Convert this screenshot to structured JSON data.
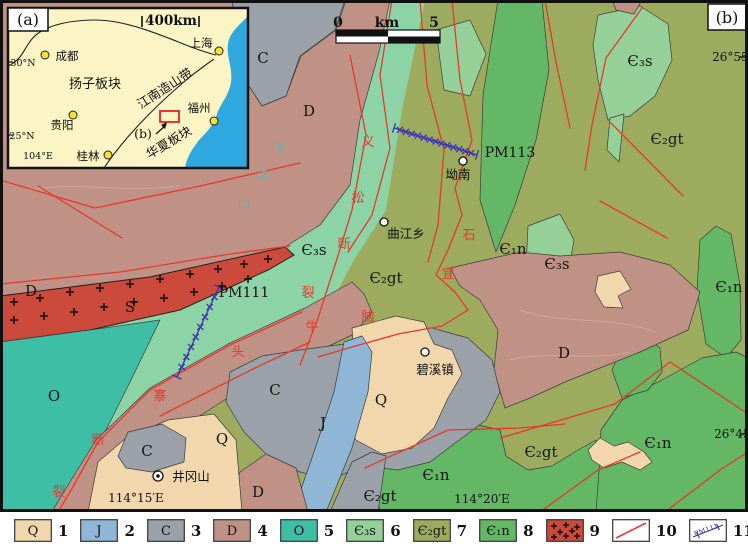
{
  "colors": {
    "units": {
      "Q": "#F2D7AD",
      "J": "#90B6D5",
      "C": "#9BA1A8",
      "D": "#BF9285",
      "O": "#3FBEA6",
      "E3s": "#95D099",
      "E3sB": "#8CD3A6",
      "E2gt": "#9CAB5E",
      "E1n": "#63B765",
      "granite": "#CB4A3B"
    },
    "fault_line": "#E8382C",
    "traverse_line": "#3D36A6",
    "sea": "#2FA8DF",
    "inset_land": "#FBF5C6",
    "city_dot": "#F7E03C",
    "study_area_box": "#EE1C25"
  },
  "map": {
    "panel_label": "(b)",
    "scale_bar": {
      "left": "0",
      "mid": "km",
      "right": "5"
    },
    "labels": [
      {
        "t": "C",
        "x": 263,
        "y": 63,
        "k": "unit",
        "s": 17
      },
      {
        "t": "D",
        "x": 309,
        "y": 116,
        "k": "unit",
        "s": 17
      },
      {
        "t": "D",
        "x": 31,
        "y": 296,
        "k": "unit",
        "s": 17
      },
      {
        "t": "S",
        "x": 130,
        "y": 312,
        "k": "unit",
        "s": 15
      },
      {
        "t": "O",
        "x": 54,
        "y": 401,
        "k": "unit",
        "s": 17
      },
      {
        "t": "C",
        "x": 147,
        "y": 456,
        "k": "unit",
        "s": 15
      },
      {
        "t": "Q",
        "x": 222,
        "y": 444,
        "k": "unit",
        "s": 17
      },
      {
        "t": "C",
        "x": 275,
        "y": 395,
        "k": "unit",
        "s": 15
      },
      {
        "t": "J",
        "x": 323,
        "y": 428,
        "k": "unit",
        "s": 15
      },
      {
        "t": "D",
        "x": 258,
        "y": 497,
        "k": "unit",
        "s": 15
      },
      {
        "t": "Q",
        "x": 381,
        "y": 405,
        "k": "unit",
        "s": 14
      },
      {
        "t": "D",
        "x": 564,
        "y": 358,
        "k": "unit",
        "s": 17
      },
      {
        "t": "Є₃s",
        "x": 314,
        "y": 255,
        "k": "unit"
      },
      {
        "t": "Є₂gt",
        "x": 386,
        "y": 283,
        "k": "unit"
      },
      {
        "t": "Є₃s",
        "x": 640,
        "y": 66,
        "k": "unit"
      },
      {
        "t": "Є₂gt",
        "x": 667,
        "y": 144,
        "k": "unit"
      },
      {
        "t": "Є₁n",
        "x": 513,
        "y": 254,
        "k": "unit"
      },
      {
        "t": "Є₃s",
        "x": 557,
        "y": 269,
        "k": "unit"
      },
      {
        "t": "Є₁n",
        "x": 729,
        "y": 292,
        "k": "unit"
      },
      {
        "t": "Є₂gt",
        "x": 541,
        "y": 457,
        "k": "unit"
      },
      {
        "t": "Є₁n",
        "x": 658,
        "y": 448,
        "k": "unit"
      },
      {
        "t": "Є₁n",
        "x": 436,
        "y": 480,
        "k": "unit"
      },
      {
        "t": "Є₂gt",
        "x": 380,
        "y": 501,
        "k": "unit"
      },
      {
        "t": "坳南",
        "x": 458,
        "y": 179,
        "k": "town"
      },
      {
        "t": "曲江乡",
        "x": 406,
        "y": 238,
        "k": "town"
      },
      {
        "t": "碧溪镇",
        "x": 435,
        "y": 374,
        "k": "town"
      },
      {
        "t": "井冈山",
        "x": 191,
        "y": 481,
        "k": "town"
      },
      {
        "t": "PM113",
        "x": 510,
        "y": 157,
        "k": "trav"
      },
      {
        "t": "PM111",
        "x": 244,
        "y": 297,
        "k": "trav"
      },
      {
        "t": "义",
        "x": 368,
        "y": 146,
        "k": "fault"
      },
      {
        "t": "松",
        "x": 358,
        "y": 202,
        "k": "fault"
      },
      {
        "t": "断",
        "x": 344,
        "y": 248,
        "k": "fault"
      },
      {
        "t": "裂",
        "x": 308,
        "y": 297,
        "k": "fault"
      },
      {
        "t": "牛",
        "x": 312,
        "y": 331,
        "k": "fault"
      },
      {
        "t": "头",
        "x": 238,
        "y": 356,
        "k": "fault"
      },
      {
        "t": "寨",
        "x": 160,
        "y": 400,
        "k": "fault"
      },
      {
        "t": "断",
        "x": 98,
        "y": 444,
        "k": "fault"
      },
      {
        "t": "裂",
        "x": 59,
        "y": 496,
        "k": "fault"
      },
      {
        "t": "石",
        "x": 469,
        "y": 239,
        "k": "fault"
      },
      {
        "t": "宜",
        "x": 448,
        "y": 278,
        "k": "fault"
      },
      {
        "t": "脑",
        "x": 368,
        "y": 321,
        "k": "fault"
      },
      {
        "t": "南",
        "x": 278,
        "y": 151,
        "k": "mtn"
      },
      {
        "t": "华",
        "x": 263,
        "y": 179,
        "k": "mtn"
      },
      {
        "t": "山",
        "x": 244,
        "y": 208,
        "k": "mtn"
      },
      {
        "t": "26°55′N",
        "x": 737,
        "y": 61,
        "k": "coord",
        "a": "end"
      },
      {
        "t": "26°45′N",
        "x": 739,
        "y": 438,
        "k": "coord",
        "a": "end"
      },
      {
        "t": "114°15′E",
        "x": 136,
        "y": 502,
        "k": "coord"
      },
      {
        "t": "114°20′E",
        "x": 482,
        "y": 503,
        "k": "coord"
      },
      {
        "t": "0",
        "x": 338,
        "y": 27,
        "k": "scale"
      },
      {
        "t": "km",
        "x": 387,
        "y": 27,
        "k": "scale"
      },
      {
        "t": "5",
        "x": 434,
        "y": 27,
        "k": "scale"
      }
    ],
    "towns": [
      {
        "name": "坳南",
        "x": 463,
        "y": 161,
        "double": false
      },
      {
        "name": "曲江乡",
        "x": 384,
        "y": 222,
        "double": false
      },
      {
        "name": "碧溪镇",
        "x": 425,
        "y": 352,
        "double": false
      },
      {
        "name": "井冈山",
        "x": 158,
        "y": 476,
        "double": true
      }
    ],
    "traverses": [
      {
        "name": "PM113",
        "x1": 394,
        "y1": 128,
        "x2": 477,
        "y2": 155,
        "n": 13
      },
      {
        "name": "PM111",
        "x1": 219,
        "y1": 287,
        "x2": 177,
        "y2": 377,
        "n": 8
      }
    ]
  },
  "inset": {
    "panel_label": "(a)",
    "labels": [
      {
        "t": "400km",
        "x": 163,
        "y": 17,
        "s": 13.5,
        "w": 700
      },
      {
        "t": "扬子板块",
        "x": 87,
        "y": 80,
        "s": 13
      },
      {
        "t": "江南造山带",
        "x": 159,
        "y": 84,
        "s": 12.5,
        "rot": -33
      },
      {
        "t": "华夏板块",
        "x": 163,
        "y": 138,
        "s": 12.5,
        "rot": -31
      },
      {
        "t": "(b)",
        "x": 135,
        "y": 130,
        "s": 12.5
      },
      {
        "t": "30°N",
        "x": 15,
        "y": 58,
        "s": 9.5
      },
      {
        "t": "25°N",
        "x": 14,
        "y": 131,
        "s": 9.5
      },
      {
        "t": "104°E",
        "x": 30,
        "y": 151,
        "s": 9.5
      }
    ],
    "cities": [
      {
        "name": "成都",
        "dot": [
          37,
          47
        ],
        "label": [
          59,
          52
        ]
      },
      {
        "name": "上海",
        "dot": [
          211,
          43
        ],
        "label": [
          193,
          39
        ]
      },
      {
        "name": "贵阳",
        "dot": [
          65,
          107
        ],
        "label": [
          54,
          121
        ]
      },
      {
        "name": "桂林",
        "dot": [
          100,
          147
        ],
        "label": [
          80,
          152
        ]
      },
      {
        "name": "福州",
        "dot": [
          206,
          113
        ],
        "label": [
          191,
          104
        ]
      }
    ]
  },
  "legend": {
    "items": [
      {
        "num": "1",
        "code": "Q",
        "type": "unit",
        "color": "Q"
      },
      {
        "num": "2",
        "code": "J",
        "type": "unit",
        "color": "J"
      },
      {
        "num": "3",
        "code": "C",
        "type": "unit",
        "color": "C"
      },
      {
        "num": "4",
        "code": "D",
        "type": "unit",
        "color": "D"
      },
      {
        "num": "5",
        "code": "O",
        "type": "unit",
        "color": "O"
      },
      {
        "num": "6",
        "code": "Є₃s",
        "type": "unit",
        "color": "E3s"
      },
      {
        "num": "7",
        "code": "Є₂gt",
        "type": "unit",
        "color": "E2gt"
      },
      {
        "num": "8",
        "code": "Є₁n",
        "type": "unit",
        "color": "E1n"
      },
      {
        "num": "9",
        "code": "",
        "type": "granite",
        "color": "granite"
      },
      {
        "num": "10",
        "code": "",
        "type": "fault",
        "color": "fault_line"
      },
      {
        "num": "11",
        "code": "PM111",
        "type": "traverse",
        "color": "traverse_line"
      },
      {
        "num": "12",
        "code": "",
        "type": "cross",
        "color": "traverse_line"
      }
    ]
  }
}
